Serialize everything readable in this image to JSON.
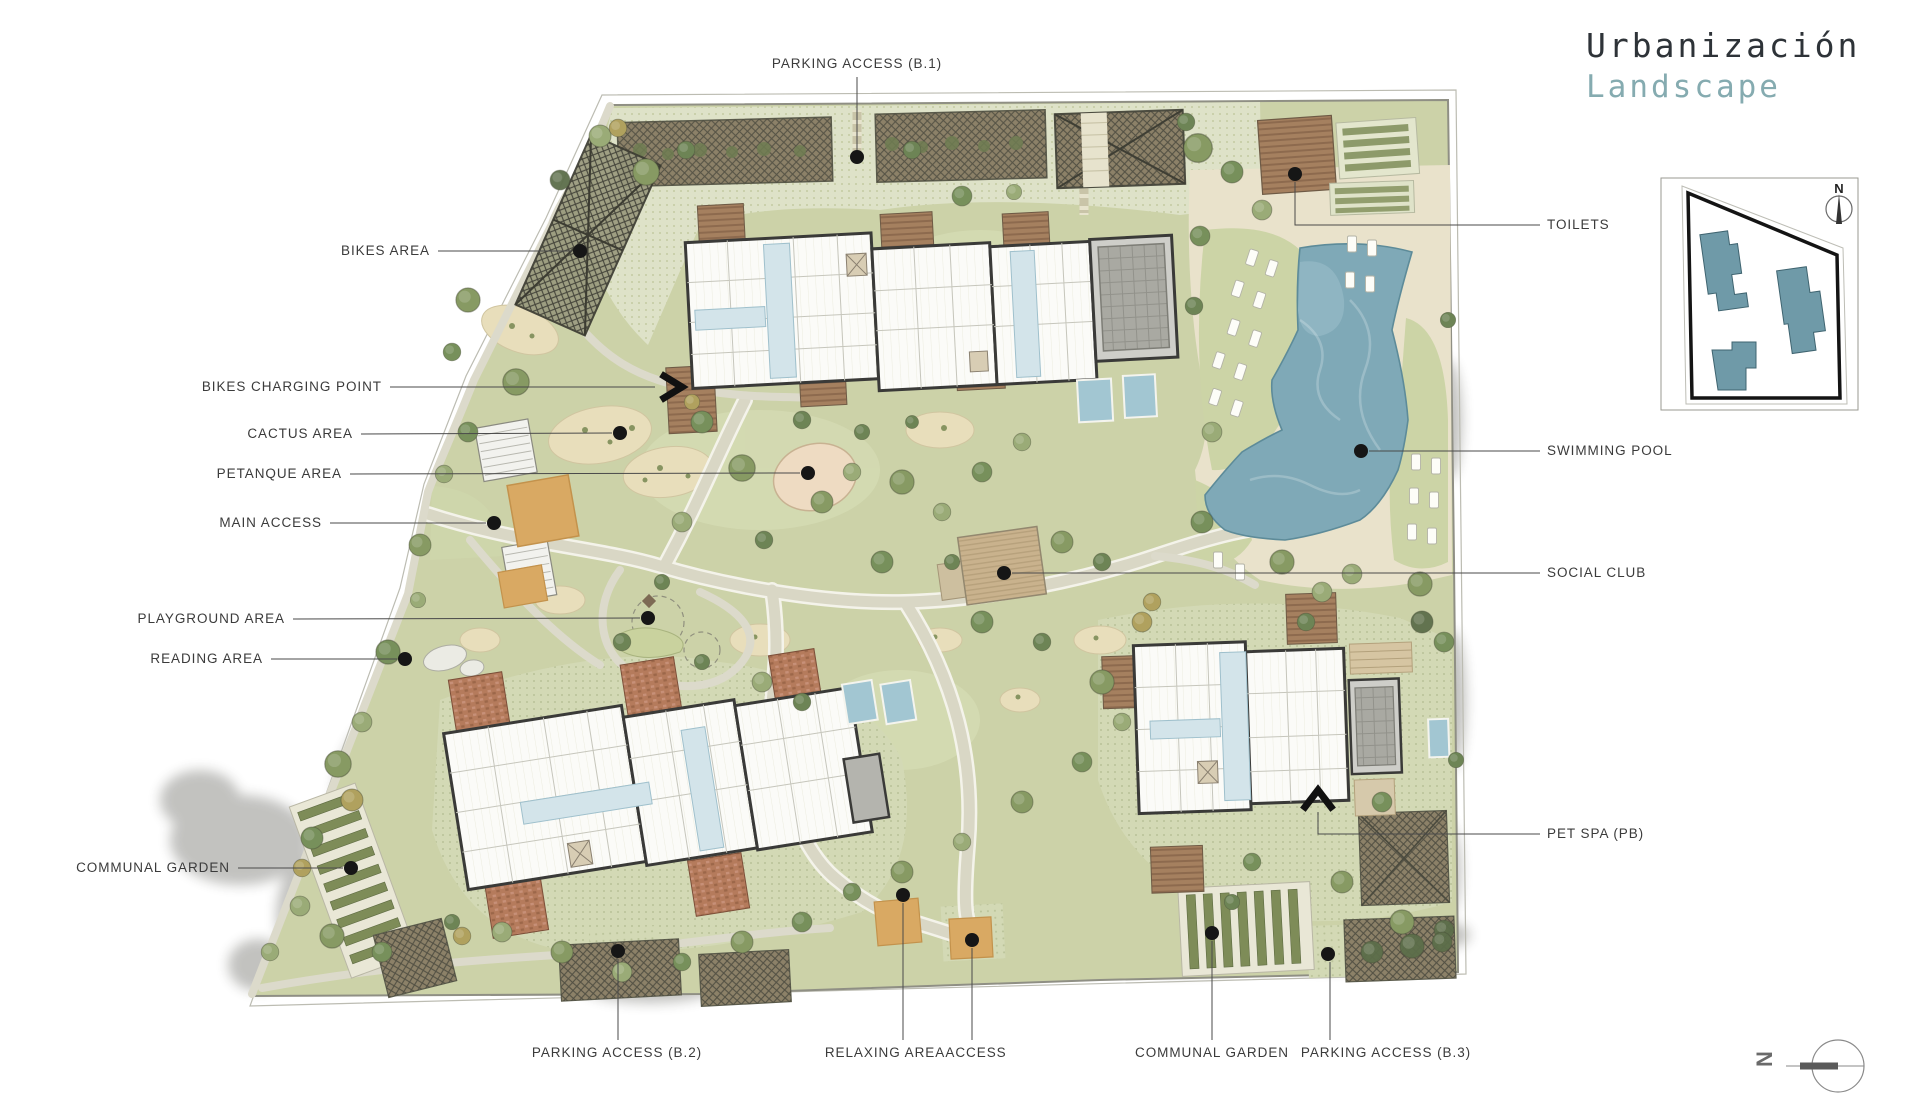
{
  "title": {
    "line1": "Urbanización",
    "line2": "Landscape",
    "line1_color": "#2e3338",
    "line2_color": "#85abb0"
  },
  "labels": {
    "parking_b1": "PARKING ACCESS (B.1)",
    "bikes_area": "BIKES AREA",
    "bikes_charging": "BIKES CHARGING POINT",
    "cactus": "CACTUS AREA",
    "petanque": "PETANQUE AREA",
    "main_access": "MAIN ACCESS",
    "playground": "PLAYGROUND AREA",
    "reading": "READING AREA",
    "communal_garden_left": "COMMUNAL GARDEN",
    "toilets": "TOILETS",
    "swimming_pool": "SWIMMING POOL",
    "social_club": "SOCIAL CLUB",
    "pet_spa": "PET SPA (PB)",
    "parking_b2": "PARKING ACCESS (B.2)",
    "relaxing": "RELAXING AREA",
    "access": "ACCESS",
    "communal_garden_right": "COMMUNAL GARDEN",
    "parking_b3": "PARKING ACCESS (B.3)"
  },
  "inset": {
    "north_label": "N"
  },
  "compass": {
    "north_label": "N"
  },
  "colors": {
    "lawn": "#ccd2a8",
    "paving": "#dee2c8",
    "sand_deck": "#e9e2cb",
    "pool_water": "#7fa9b7",
    "building_white": "#fbfbf8",
    "wall_dark": "#3a3a38",
    "terrace_brown": "#a5805f",
    "terrace_brick": "#b57b5c",
    "roof_gray": "#cecec9",
    "club_roof_tan": "#c9b28d",
    "access_canopy": "#d9a963",
    "inset_building_teal": "#6f9aa8",
    "label_text": "#3b3b3b",
    "leader_dot": "#161616"
  }
}
